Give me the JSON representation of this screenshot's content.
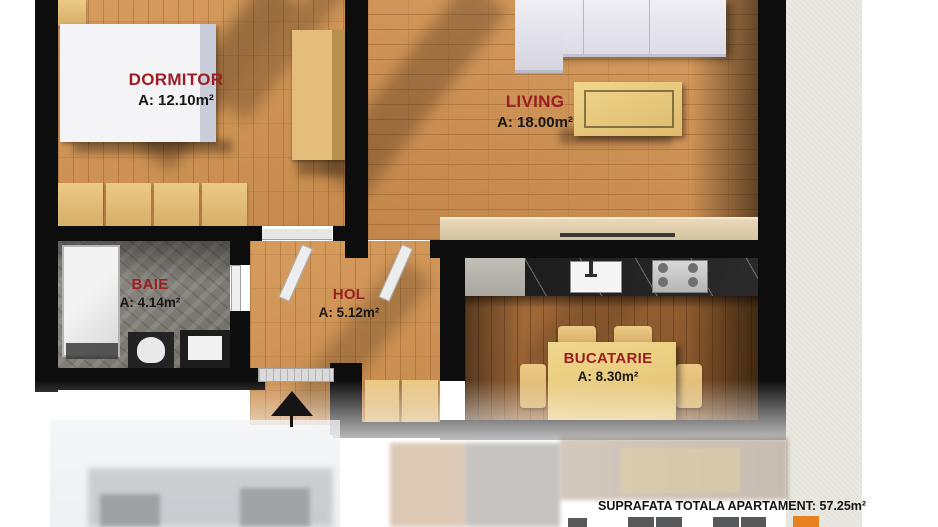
{
  "plan_title": "Apartment floor plan",
  "rooms": [
    {
      "id": "dormitor",
      "name": "DORMITOR",
      "area": "A: 12.10m²"
    },
    {
      "id": "living",
      "name": "LIVING",
      "area": "A: 18.00m²"
    },
    {
      "id": "baie",
      "name": "BAIE",
      "area": "A: 4.14m²"
    },
    {
      "id": "hol",
      "name": "HOL",
      "area": "A: 5.12m²"
    },
    {
      "id": "bucatarie",
      "name": "BUCATARIE",
      "area": "A: 8.30m²"
    }
  ],
  "footer": {
    "total_area_label": "SUPRAFATA TOTALA APARTAMENT: 57.25m²"
  },
  "colors": {
    "room_label_red": "#9b1e23",
    "area_text": "#171717",
    "wall_black": "#0d0d0d",
    "wood_floor": "#cf9254",
    "kitchen_wood": "#9a6234",
    "bathroom_stone": "#84817b",
    "furniture_tan": "#e9cb82",
    "paper_background": "#e9e8e1",
    "legend_grey": "#57585a",
    "legend_orange": "#e8821e"
  }
}
